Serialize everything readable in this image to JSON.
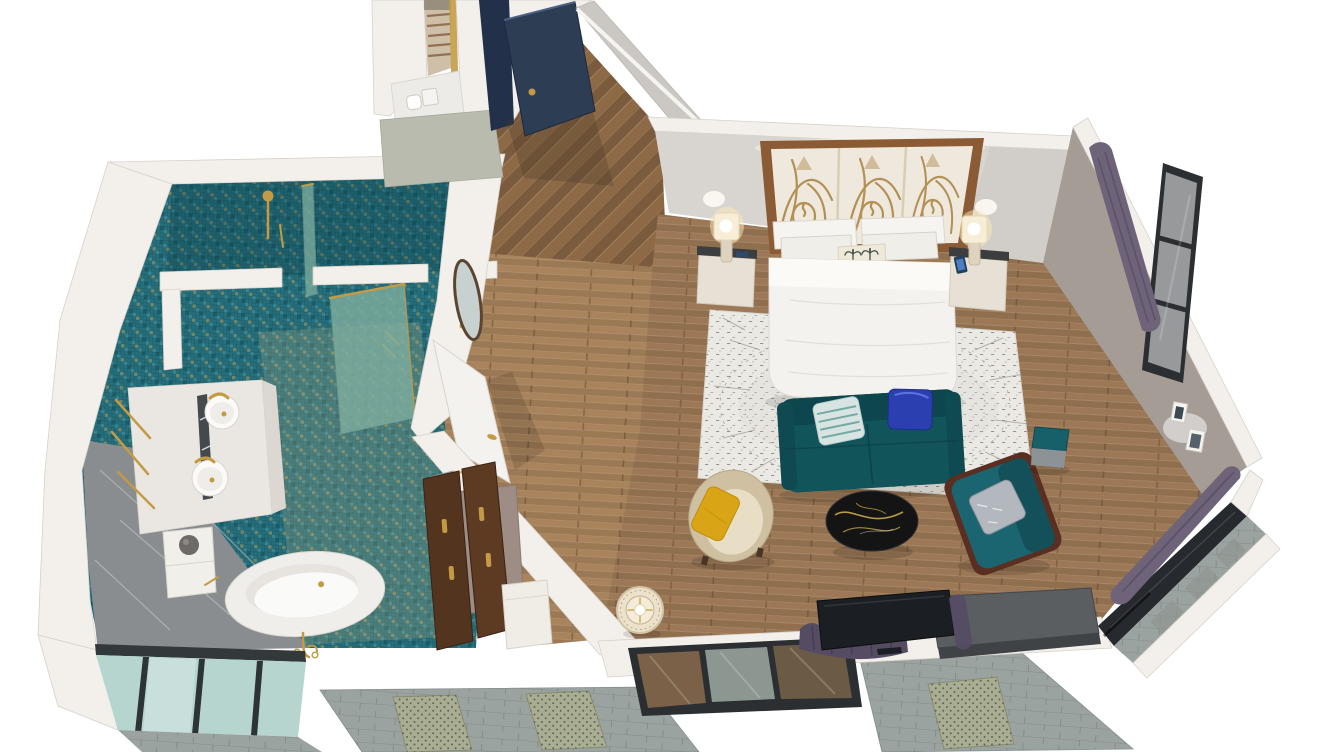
{
  "scene": {
    "view": "isometric-cutaway-3d-render",
    "subject": "Hotel suite floor plan: bedroom with en-suite bathroom",
    "rooms": [
      {
        "id": "bathroom",
        "floor_finish": "teal mosaic tile with gold flecks",
        "fixtures": [
          "walk-in-shower",
          "glass-partitions",
          "rain-shower-head",
          "double-vanity",
          "round-vessel-sinks",
          "gold-faucets",
          "gold-towel-bars",
          "storage-cabinet",
          "freestanding-oval-bathtub",
          "floor-mounted-tub-filler",
          "frosted-window",
          "gray-marble-accent"
        ]
      },
      {
        "id": "entry-hall",
        "floor_finish": "herringbone wood",
        "fixtures": [
          "navy-entry-door",
          "linen-closet-with-baskets",
          "toilet-alcove",
          "oval-mirror",
          "white-interior-door"
        ]
      },
      {
        "id": "bedroom",
        "floor_finish": "wood plank",
        "fixtures": [
          "king-bed-white-bedding",
          "carved-three-panel-headboard",
          "palm-print-accent-pillow",
          "nightstand-left",
          "nightstand-right",
          "lit-table-lamps",
          "smartphone",
          "speckled-area-rug",
          "teal-velvet-sofa",
          "striped-pillow",
          "royal-blue-pillow",
          "cream-barrel-chair",
          "mustard-pillow",
          "black-marble-coffee-table",
          "teal-armchair-wood-frame",
          "silver-pillow",
          "teal-cube-stool",
          "rattan-floor-lamp",
          "flat-screen-tv",
          "media-console",
          "open-wardrobe-gold-handles",
          "luggage-bench",
          "full-length-mirror",
          "purple-curtains",
          "framed-wall-art",
          "tall-picture-window",
          "angled-corner-window",
          "stone-facade-lattice-panels"
        ]
      }
    ]
  },
  "palette": {
    "bg": "#ffffff",
    "wall_white": "#f3f0ec",
    "wall_edge": "#d6d1ca",
    "wall_gray": "#d8d5d1",
    "wall_panel": "#cbc8c3",
    "wall_green": "#b8bbad",
    "wall_taupe": "#a59c96",
    "tile_teal": "#266f7c",
    "tile_gold": "#c5a45a",
    "wood_floor": "#9c7856",
    "wood_entry": "#8d6946",
    "wood_hall_light": "#a8835c",
    "marble_gray": "#898d90",
    "counter_marble": "#eae7e2",
    "tub_white": "#f0eeea",
    "gold_metal": "#c39b45",
    "door_navy": "#2d3d54",
    "shower_glass": "#7fae9f",
    "window_frost": "#b7d5cf",
    "frame_dark": "#2b2f32",
    "sofa_teal": "#11545a",
    "armchair_teal": "#1b6570",
    "stool_teal": "#176069",
    "chair_cream": "#cfc0a2",
    "pillow_yellow": "#d9a517",
    "pillow_blue": "#2b3fb0",
    "pillow_stripe": "#d7e4e2",
    "pillow_silver": "#b3b8bf",
    "rug_white": "#ebe9e3",
    "table_black": "#141414",
    "curtain_purple": "#6e6378",
    "curtain_dark": "#554c63",
    "tv_black": "#1b1e22",
    "console_gray": "#5a5e60",
    "facade_gray": "#9ba3a0",
    "lattice_green": "#a9ae93",
    "wardrobe_wood": "#53341f",
    "headboard_wood": "#8a5b34",
    "panel_cream": "#efe8dc",
    "lamp_cream": "#e8dcc4",
    "glow_warm": "#fff3d8"
  }
}
